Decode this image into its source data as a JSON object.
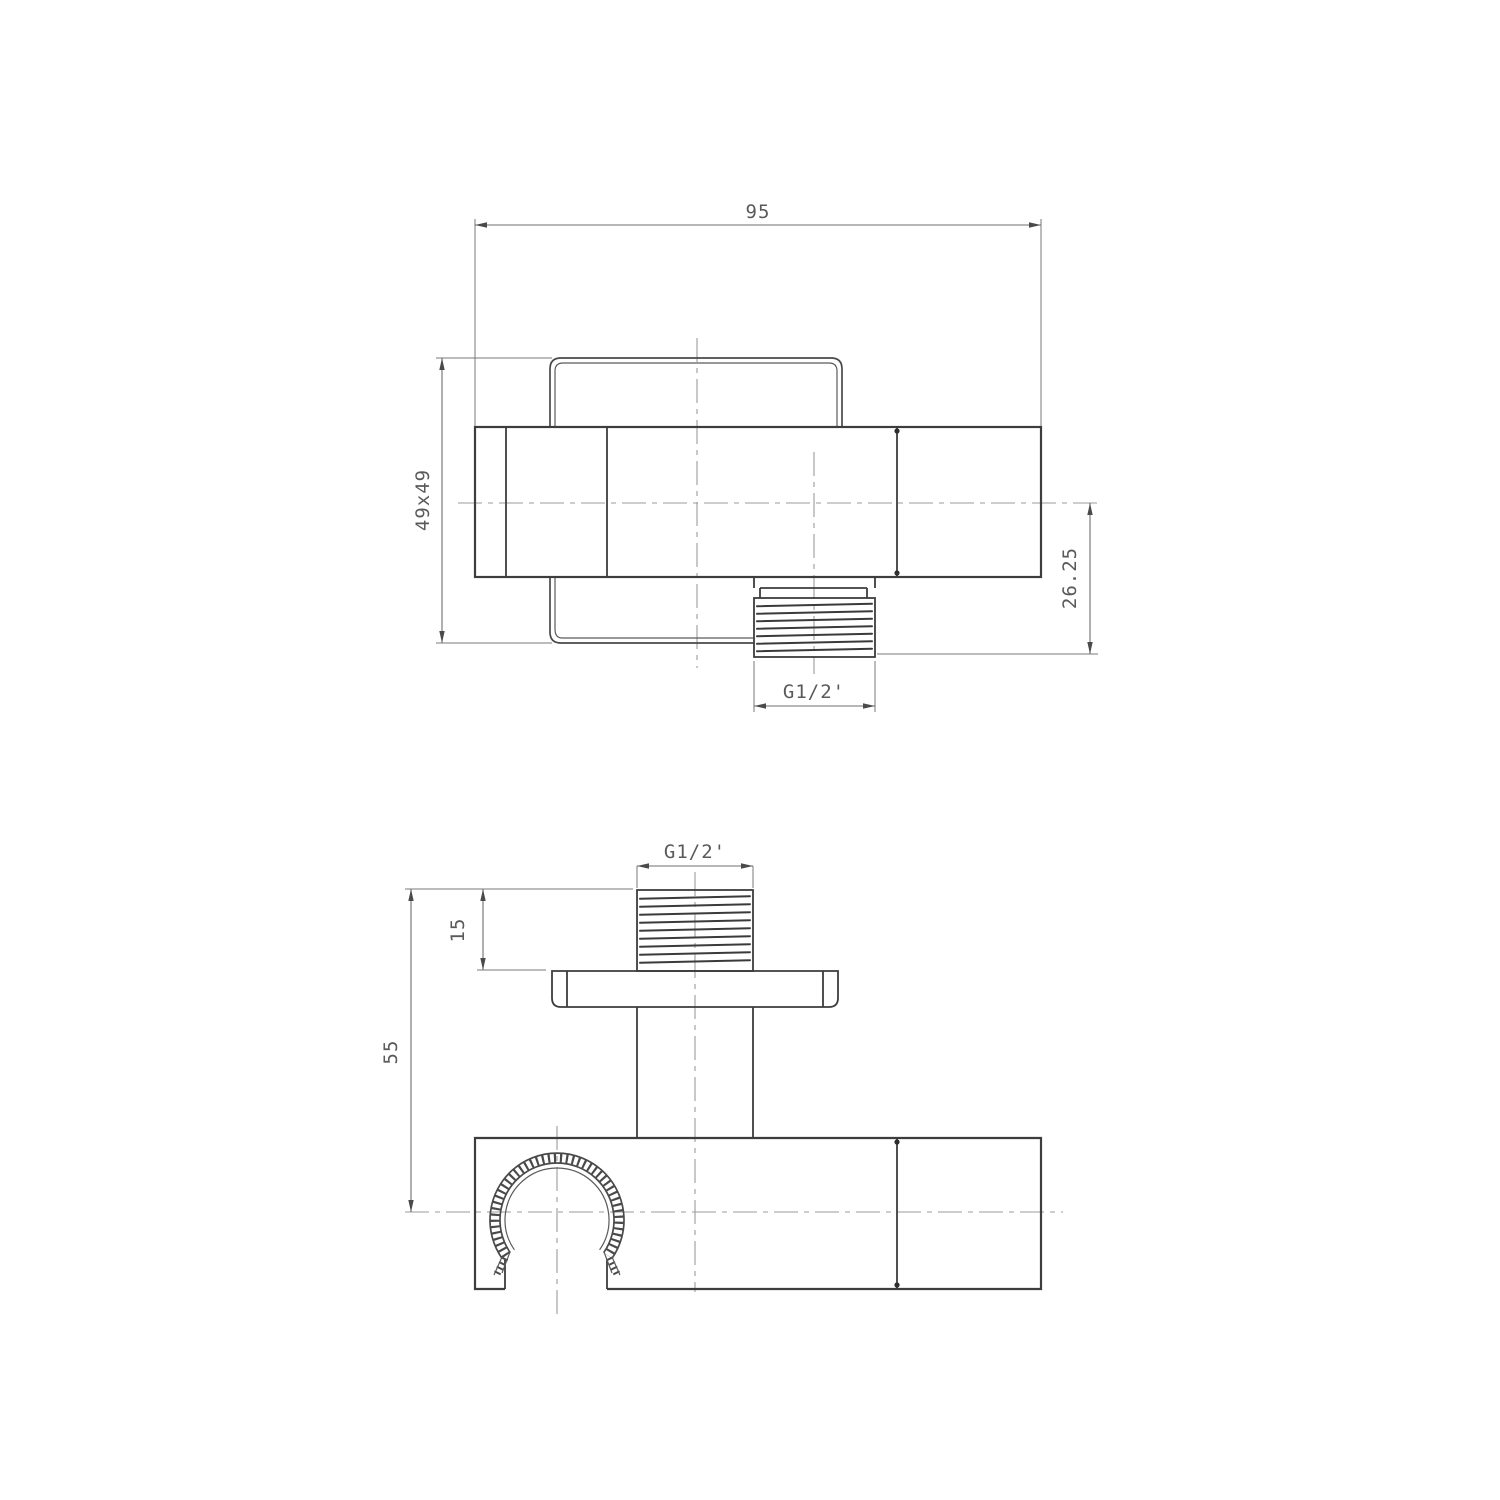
{
  "drawing": {
    "description": "Technical drawing, two orthographic views of a shower outlet elbow with hand-shower holder",
    "line_color": "#3d3d3d",
    "dim_color": "#6f6f6f",
    "centerline_color": "#9b9b9b",
    "background": "#ffffff",
    "top": {
      "width": "95",
      "section": "49x49",
      "offset": "26.25",
      "thread": "G1/2'"
    },
    "bottom": {
      "thread": "G1/2'",
      "thread_length": "15",
      "height": "55"
    }
  }
}
